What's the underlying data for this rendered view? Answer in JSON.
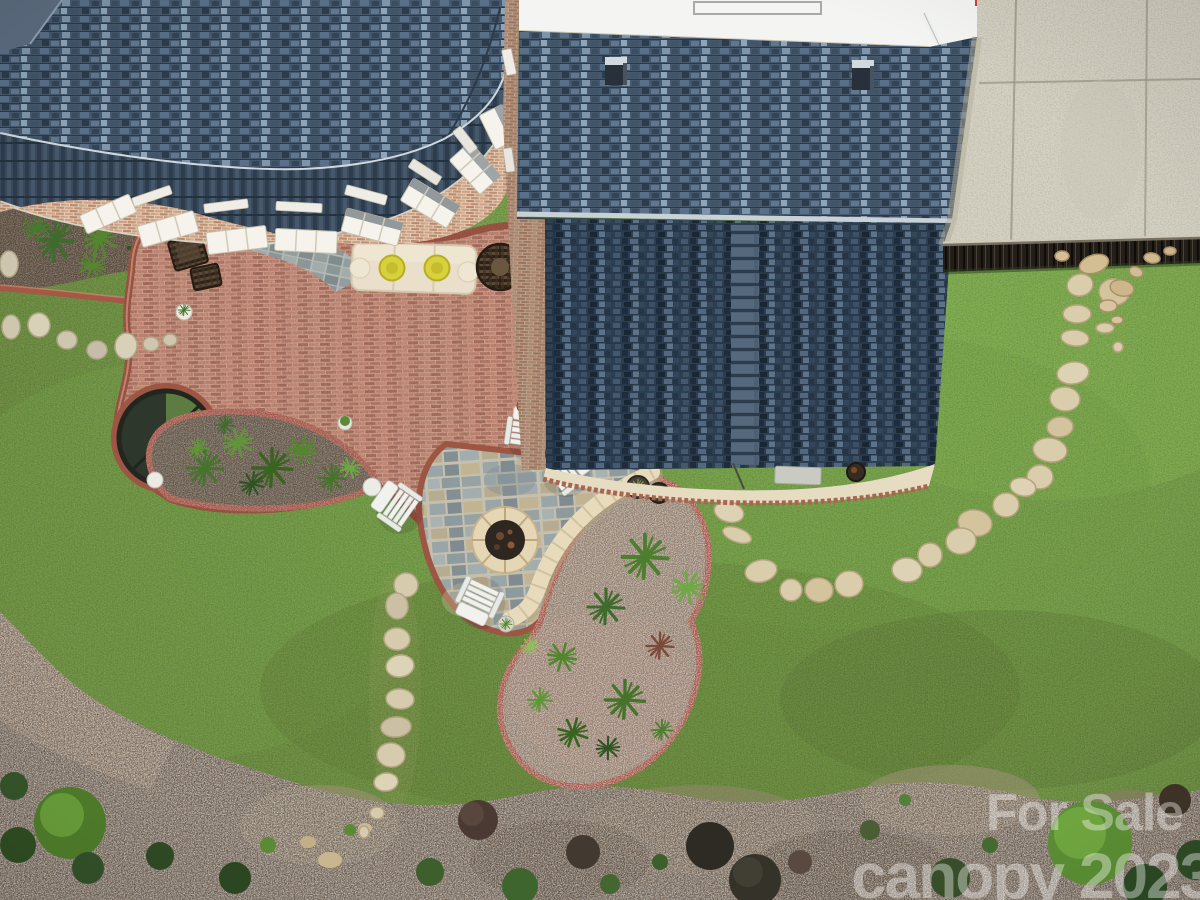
{
  "meta": {
    "title": "Aerial backyard photo",
    "description": "Overhead drone photograph of a home's backyard: curved brick paver patio, flagstone fire-pit area with white adirondack chairs, kidney-shaped planting beds, stepping-stone paths across a lawn, dark shingle roofs, concrete pad and mulched garden borders."
  },
  "watermark": {
    "line1": "For Sale",
    "line2": "canopy 2023",
    "color": "#ffffff"
  },
  "palette": {
    "lawn_green": "#6f9c42",
    "roof_slate": "#45566b",
    "roof_dark": "#2d3e51",
    "patio_brick": "#c08573",
    "brick_border": "#9d5544",
    "flagstone_gray": "#8d9a9e",
    "firepit_stone": "#e5d6b5",
    "mulch_brown": "#8a7a6b",
    "concrete": "#d5d2c3",
    "stepping_stone": "#d9cdab",
    "fence_dark": "#241e18"
  },
  "visible_objects": [
    "shingle roof",
    "bay window roof",
    "brick house wall with windows",
    "white roof band with skylight",
    "concrete pad",
    "privacy fence",
    "brick paver patio",
    "slate walkway",
    "flagstone patio",
    "stone fire pit",
    "adirondack chairs",
    "outdoor sofa with yellow poufs",
    "wicker chairs",
    "round garden feature",
    "planting beds",
    "stepping stone paths",
    "lawn",
    "mulch beds",
    "shrubs"
  ]
}
